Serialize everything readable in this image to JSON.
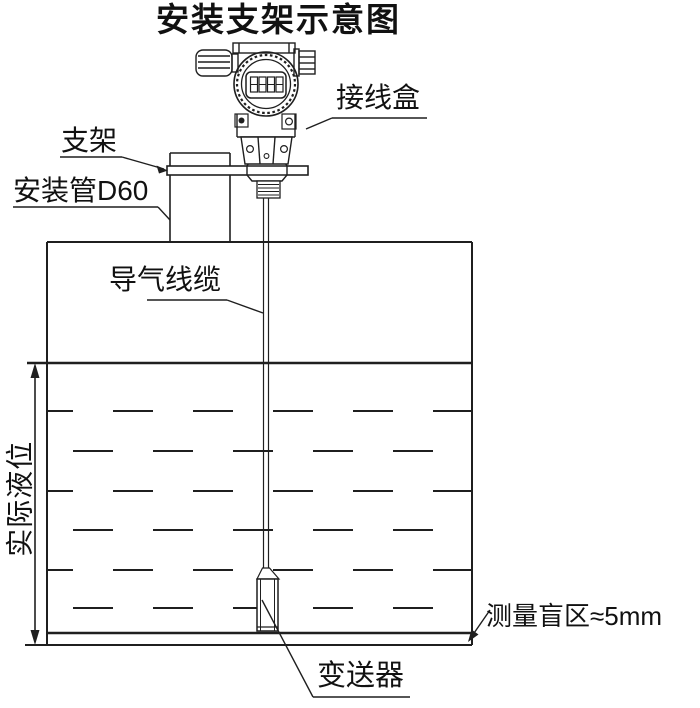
{
  "title": "安装支架示意图",
  "labels": {
    "junction_box": "接线盒",
    "bracket": "支架",
    "mounting_pipe": "安装管D60",
    "air_cable": "导气线缆",
    "actual_level": "实际液位",
    "blind_zone": "测量盲区≈5mm",
    "transmitter": "变送器"
  },
  "device": {
    "display_value": "8888"
  },
  "colors": {
    "line": "#1f1f1f",
    "background": "#ffffff",
    "text": "#111111"
  }
}
